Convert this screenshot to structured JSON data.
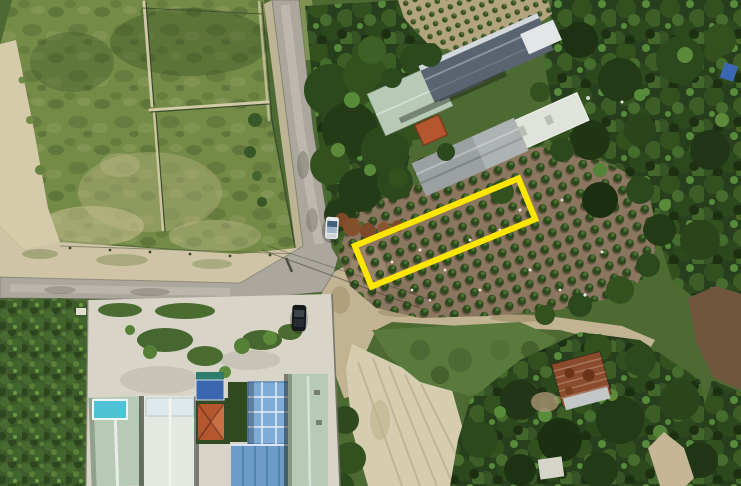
{
  "scene": {
    "kind": "aerial-drone-photograph",
    "width_px": 741,
    "height_px": 486,
    "description": "Top-down drone photo of a rural crossroads: a fenced grass field upper-left with a sandy track, paved roads meeting at a junction, an orchard of small round trees where a yellow rectangle outlines a land plot for sale, farm buildings with metal roofs above the orchard, a residential compound with a swimming pool and blue glass roof below the road, dense forest on the right, a bare plowed field bottom-centre and a rusty-roof house lower right."
  },
  "highlight": {
    "name": "land-plot-outline",
    "shape": "rotated-rectangle",
    "color": "#FFE600",
    "center": {
      "x": 445,
      "y": 232
    },
    "length_px": 177,
    "width_px": 44,
    "rotation_deg": -22.4,
    "stroke_px": 6
  },
  "palette": {
    "grass_field": "#748A47",
    "sand": "#D5CAA9",
    "asphalt": "#ABA79C",
    "concrete": "#D8D5C8",
    "orchard_soil": "#8B7660",
    "orchard_bush": "#2C481C",
    "forest_green": "#273F1C",
    "shrub_green": "#3C5A2A",
    "bare_field": "#D6CCB0",
    "metal_roof_dark": "#5A6470",
    "metal_roof_white": "#E2E6E7",
    "mint_roof": "#B6CAB6",
    "white_roof": "#E4E8E0",
    "gray_roof": "#9BA1A3",
    "orange_roof": "#B4572E",
    "blue_glass_roof": "#7FABD8",
    "blue_roof": "#6D9CC9",
    "rust_roof": "#8B4B2D",
    "pool_water": "#4FC3D6",
    "tarp_blue": "#3B66B0",
    "white_car": "#E9EBED",
    "black_car": "#15181C"
  },
  "objects": [
    {
      "name": "grass-field",
      "desc": "fenced grass paddocks, upper left"
    },
    {
      "name": "sand-track",
      "desc": "sandy track along left edge of field"
    },
    {
      "name": "paved-road-north",
      "desc": "asphalt road from top centre down to junction"
    },
    {
      "name": "paved-road-west",
      "desc": "asphalt road from junction to left edge"
    },
    {
      "name": "dirt-road-east",
      "desc": "dirt track running east below the orchard"
    },
    {
      "name": "orchard",
      "desc": "rows of small round trees on brown soil"
    },
    {
      "name": "nursery-rows",
      "desc": "small plant rows on tan soil, top centre"
    },
    {
      "name": "land-plot-outline",
      "desc": "yellow rectangle marking the advertised plot"
    },
    {
      "name": "farm-buildings",
      "desc": "cluster of long metal-roof buildings, top centre-right"
    },
    {
      "name": "residential-compound",
      "desc": "houses with pool, glass roof and blue roofs, bottom centre"
    },
    {
      "name": "swimming-pool",
      "desc": "small cyan pool on left house"
    },
    {
      "name": "rusty-house",
      "desc": "corrugated rust-coloured roof among trees, lower right"
    },
    {
      "name": "bare-plowed-field",
      "desc": "light bare soil field, bottom centre"
    },
    {
      "name": "forest",
      "desc": "dense tree canopy on right side and bottom right"
    },
    {
      "name": "shrub-field",
      "desc": "dense low shrub, bottom left"
    },
    {
      "name": "white-car",
      "desc": "white car parked on north road"
    },
    {
      "name": "black-car",
      "desc": "dark car parked at compound entrance"
    },
    {
      "name": "power-lines",
      "desc": "thin wires crossing the junction"
    }
  ]
}
